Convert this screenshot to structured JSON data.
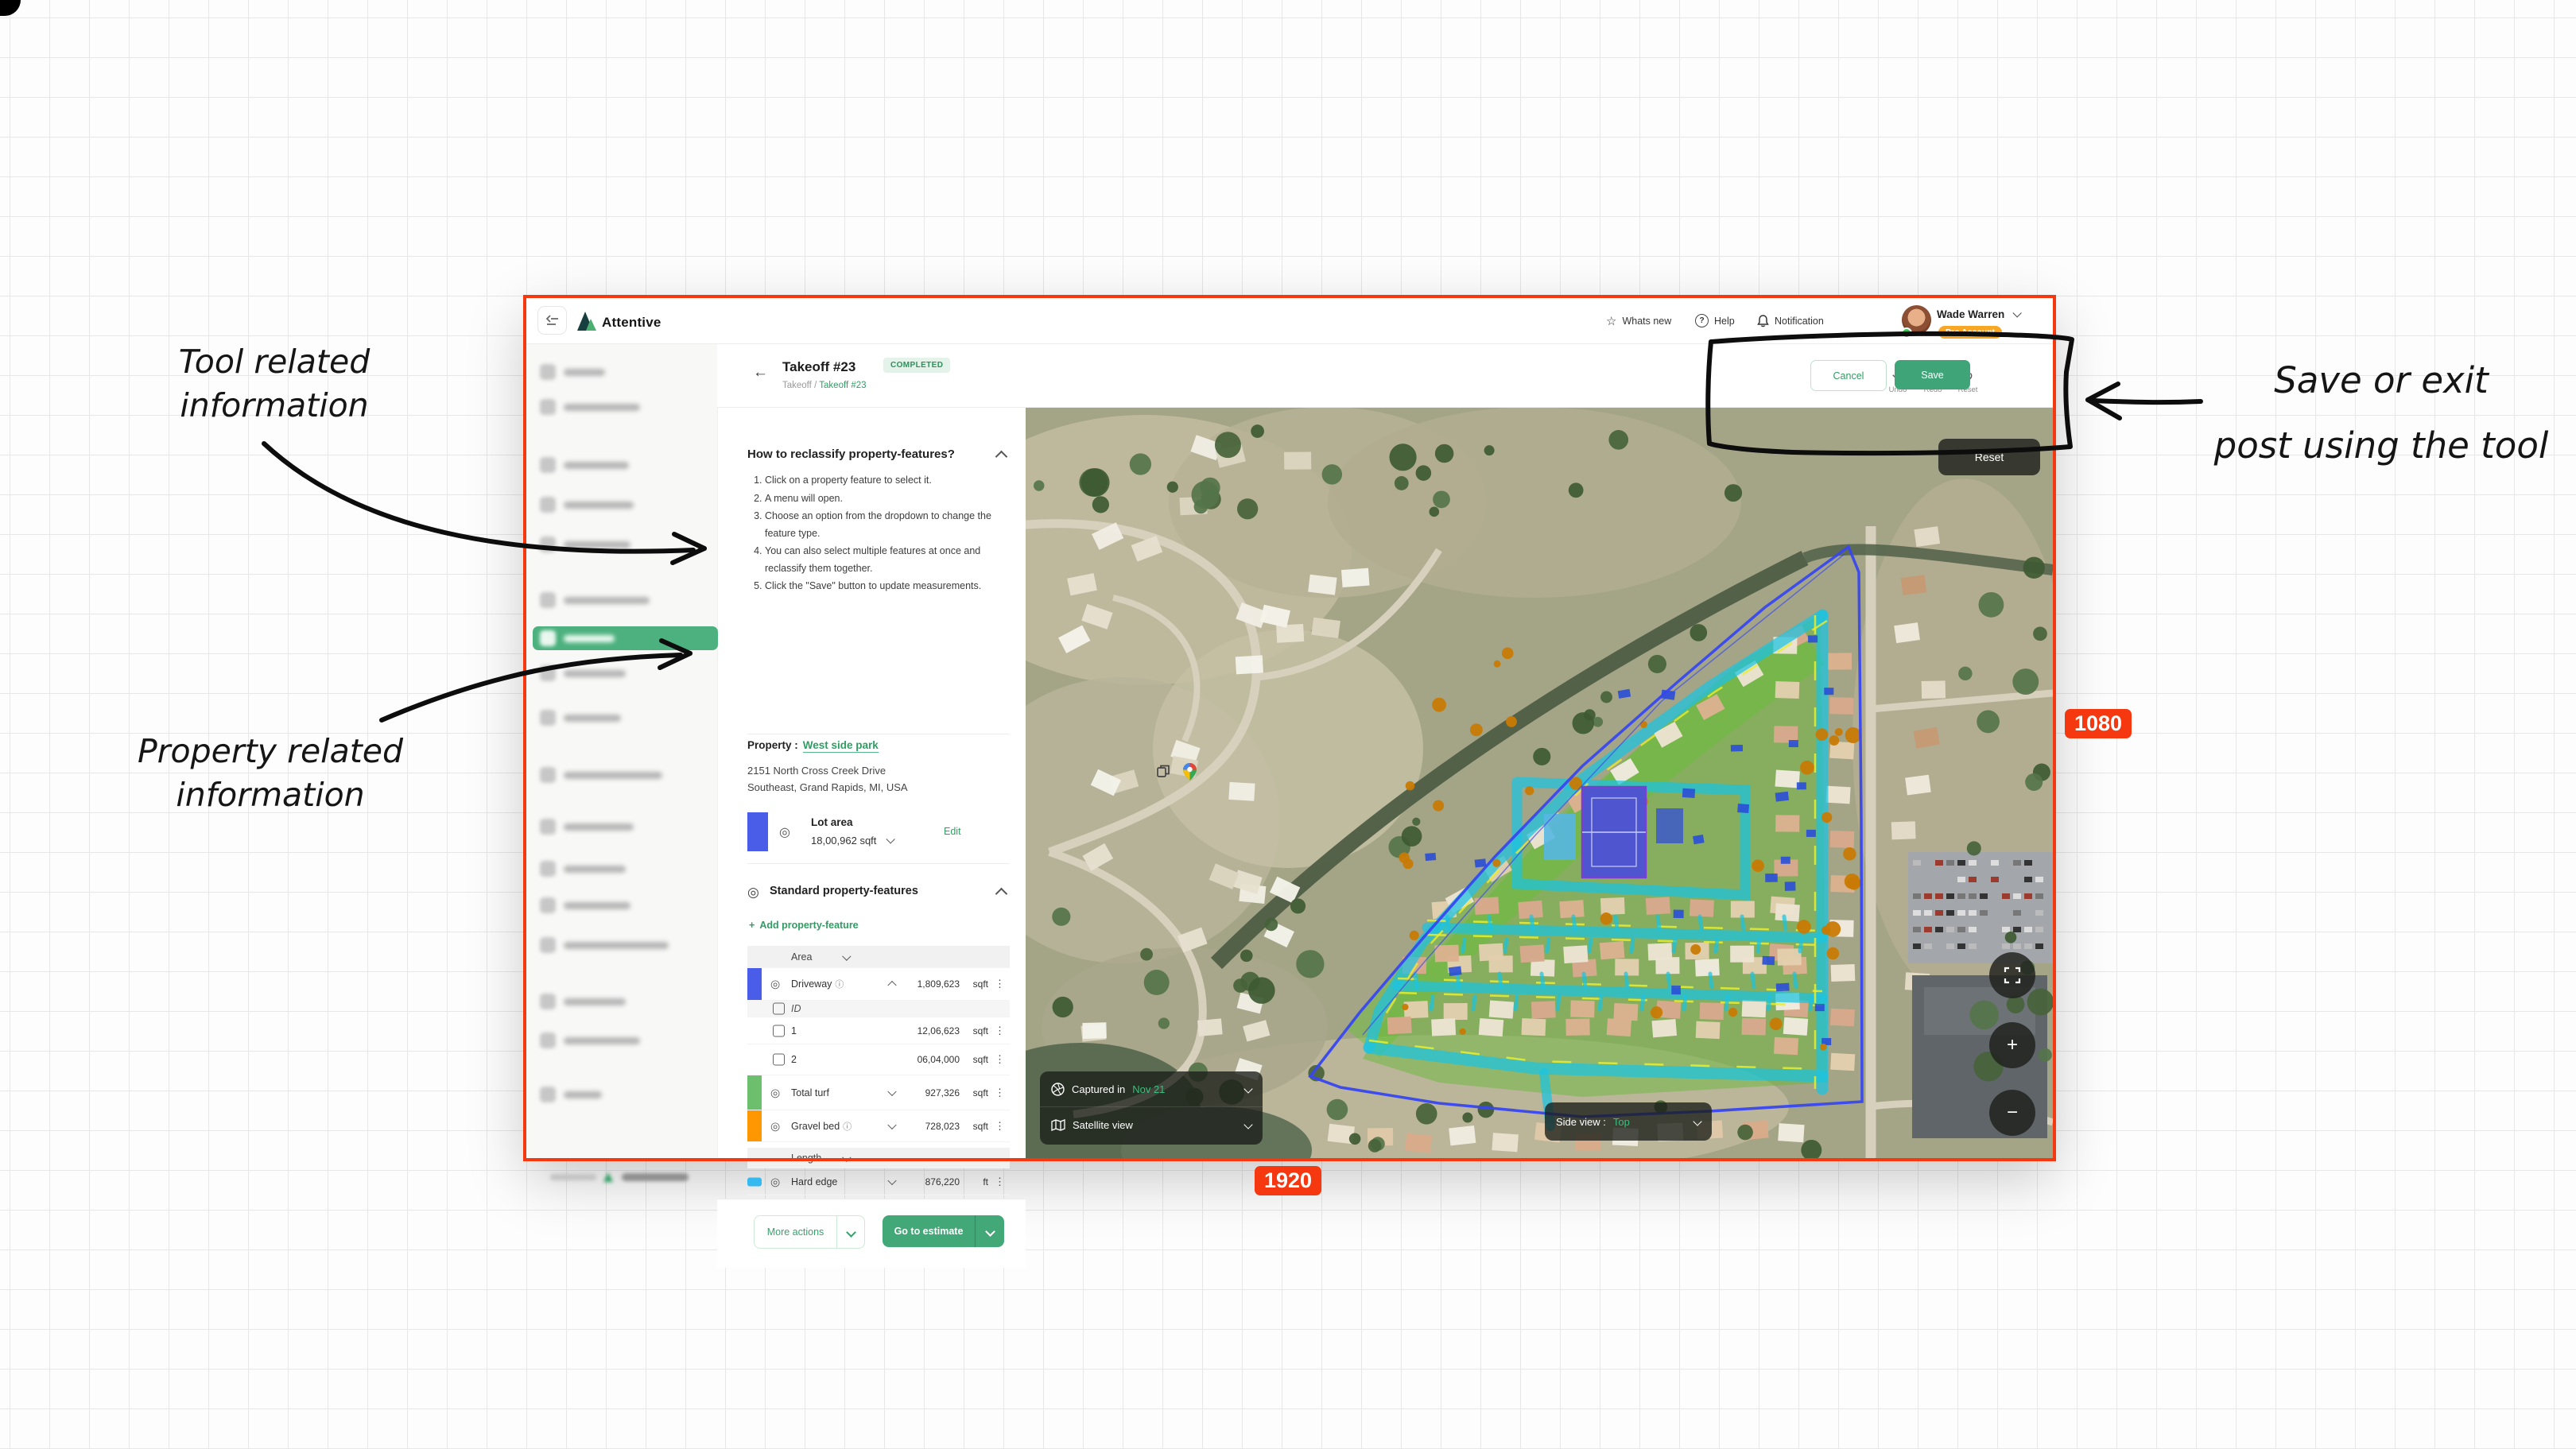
{
  "badges": {
    "width_label": "1920",
    "height_label": "1080"
  },
  "notes": {
    "tool_line1": "Tool related",
    "tool_line2": "information",
    "prop_line1": "Property related",
    "prop_line2": "information",
    "save_line1": "Save or exit",
    "save_line2": "post using the tool"
  },
  "header": {
    "logo": "Attentive",
    "whats_new": "Whats new",
    "help": "Help",
    "notification": "Notification",
    "user_name": "Wade Warren",
    "user_badge": "Pro Account"
  },
  "toolbar": {
    "title": "Takeoff #23",
    "status": "COMPLETED",
    "breadcrumb_parent": "Takeoff",
    "breadcrumb_divider": "/",
    "breadcrumb_current": "Takeoff #23",
    "undo_label": "Undo",
    "redo_label": "Redo",
    "reset_label": "Reset",
    "cancel_label": "Cancel",
    "save_label": "Save"
  },
  "panel": {
    "howto_title": "How to reclassify property-features?",
    "steps": [
      "Click on a property feature to select it.",
      "A menu will open.",
      "Choose an option from the dropdown to change the feature type.",
      "You can also select multiple features at once and reclassify them together.",
      "Click the \"Save\" button to update measurements."
    ],
    "property_label": "Property :",
    "property_name": "West side park",
    "address_line1": "2151 North Cross Creek Drive",
    "address_line2": "Southeast, Grand Rapids, MI, USA",
    "lot_title": "Lot area",
    "lot_value": "18,00,962 sqft",
    "edit_label": "Edit",
    "features_title": "Standard property-features",
    "add_feature_label": "Add property-feature",
    "feature_rows": [
      {
        "kind": "group",
        "label": "Area"
      },
      {
        "kind": "feature",
        "color": "#4a5de8",
        "name": "Driveway",
        "info": true,
        "chevron": "up",
        "value": "1,809,623",
        "unit": "sqft"
      },
      {
        "kind": "idheader",
        "label": "ID"
      },
      {
        "kind": "subrow",
        "label": "1",
        "value": "12,06,623",
        "unit": "sqft"
      },
      {
        "kind": "subrow",
        "label": "2",
        "value": "06,04,000",
        "unit": "sqft"
      },
      {
        "kind": "feature",
        "color": "#6cbf6c",
        "name": "Total turf",
        "info": false,
        "chevron": "dn",
        "value": "927,326",
        "unit": "sqft"
      },
      {
        "kind": "feature",
        "color": "#ff9800",
        "name": "Gravel bed",
        "info": true,
        "chevron": "dn",
        "value": "728,023",
        "unit": "sqft"
      },
      {
        "kind": "group",
        "label": "Length"
      },
      {
        "kind": "feature",
        "color": "#35b9f1",
        "small": true,
        "name": "Hard edge",
        "info": false,
        "chevron": "dn",
        "value": "876,220",
        "unit": "ft"
      }
    ],
    "more_actions_label": "More actions",
    "go_to_estimate_label": "Go to estimate"
  },
  "map": {
    "reset_label": "Reset",
    "captured_prefix": "Captured in",
    "captured_value": "Nov 21",
    "view_label": "Satellite view",
    "side_view_label": "Side view :",
    "side_view_value": "Top"
  },
  "colors": {
    "brand_green": "#2f9e63",
    "selected_green": "#4cb17e",
    "pro_badge_orange": "#f7a723",
    "frame_red": "#f5380f",
    "lot_boundary_blue": "#3847f0",
    "street_cyan": "#1ac4e2",
    "turf_green": "#5cba28",
    "gravel_orange": "#c87a04"
  }
}
